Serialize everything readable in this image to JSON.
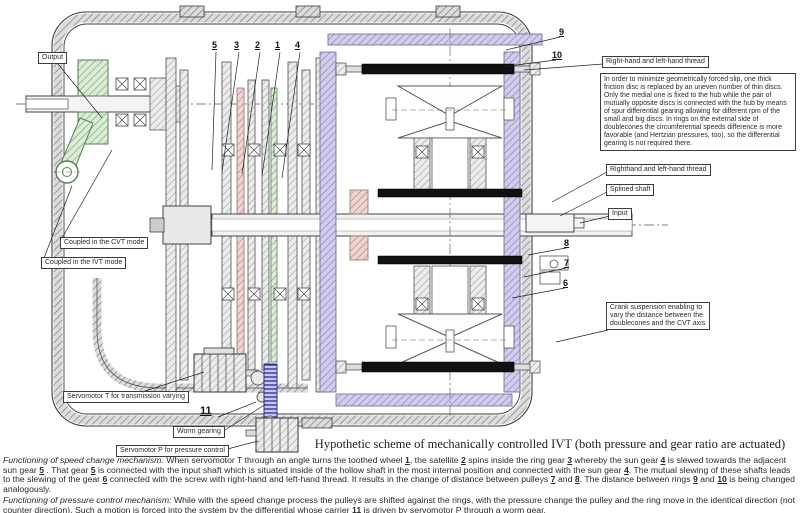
{
  "colors": {
    "highlight_green": "#a8cda0",
    "highlight_purple": "#b3a7d2",
    "highlight_red": "#c4928e",
    "worm_blue": "#3b3bbf",
    "screw_black": "#111111",
    "line": "#3a3a3a"
  },
  "diagram": {
    "title": "Hypothetic scheme of mechanically controlled IVT (both pressure and gear ratio are actuated)",
    "callouts": {
      "output": "Output",
      "thread_top": "Right-hand and left-hand thread",
      "discs_note": "In order to minimize geometrically forced slip, one thick friction disc is replaced by an uneven number of thin discs. Only the medial one is fixed to the hub while the pair of mutually opposite discs is connected with the hub by means of spur differential gearing allowing for different rpm of the small and big discs. In rings on the external side of doublecones the  circumferential speeds difference is more favorable (and Hertzian pressures, too), so the differential gearing is not required there.",
      "thread_mid": "Righthand and left-hand thread",
      "splined_shaft": "Splined shaft",
      "input": "Input",
      "crank_suspension": "Crank suspension enabling to vary the distance between the doublecones and the CVT axis",
      "coupled_cvt": "Coupled in the CVT mode",
      "coupled_ivt": "Coupled in the IVT mode",
      "servomotor_t": "Servomotor T for transmission varying",
      "worm_gearing": "Worm gearing",
      "servomotor_p": "Servomotor P  for pressure control"
    },
    "part_labels": {
      "n1": "1",
      "n2": "2",
      "n3": "3",
      "n4": "4",
      "n5": "5",
      "n6": "6",
      "n7": "7",
      "n8": "8",
      "n9": "9",
      "n10": "10",
      "n11": "11"
    }
  },
  "footer": {
    "speed_change_segments": [
      {
        "t": "Functioning of speed change mechanism:",
        "s": "i"
      },
      {
        "t": "  When servomotor T through an angle turns the toothed wheel "
      },
      {
        "t": "1",
        "s": "u"
      },
      {
        "t": ", the satellite "
      },
      {
        "t": "2",
        "s": "u"
      },
      {
        "t": " spins inside the ring gear "
      },
      {
        "t": "3",
        "s": "u"
      },
      {
        "t": "  whereby the sun gear "
      },
      {
        "t": "4",
        "s": "u"
      },
      {
        "t": " is slewed towards the adjacent sun gear "
      },
      {
        "t": "5",
        "s": "u"
      },
      {
        "t": " . That gear "
      },
      {
        "t": "5",
        "s": "u"
      },
      {
        "t": " is connected with the input shaft which is situated inside of the hollow shaft in the most internal position and connected with the sun gear "
      },
      {
        "t": "4",
        "s": "u"
      },
      {
        "t": ". The mutual slewing of these shafts leads to the slewing of the gear "
      },
      {
        "t": "6",
        "s": "u"
      },
      {
        "t": " connected with the screw with right-hand and left-hand thread. It results in the change of distance between pulleys "
      },
      {
        "t": "7",
        "s": "u"
      },
      {
        "t": " and "
      },
      {
        "t": "8",
        "s": "u"
      },
      {
        "t": ".  The distance between rings "
      },
      {
        "t": "9",
        "s": "u"
      },
      {
        "t": " and "
      },
      {
        "t": "10",
        "s": "u"
      },
      {
        "t": " is being changed analogously."
      }
    ],
    "pressure_control_segments": [
      {
        "t": "Functioning of pressure control mechanism:",
        "s": "i"
      },
      {
        "t": "  While with the speed change process the pulleys are shifted against the rings, with the pressure change the pulley and the ring move in the identical direction (not counter direction). Such a motion is forced into the system by the differential whose carrier "
      },
      {
        "t": "11",
        "s": "u"
      },
      {
        "t": " is driven by servomotor P through a worm gear."
      }
    ]
  }
}
